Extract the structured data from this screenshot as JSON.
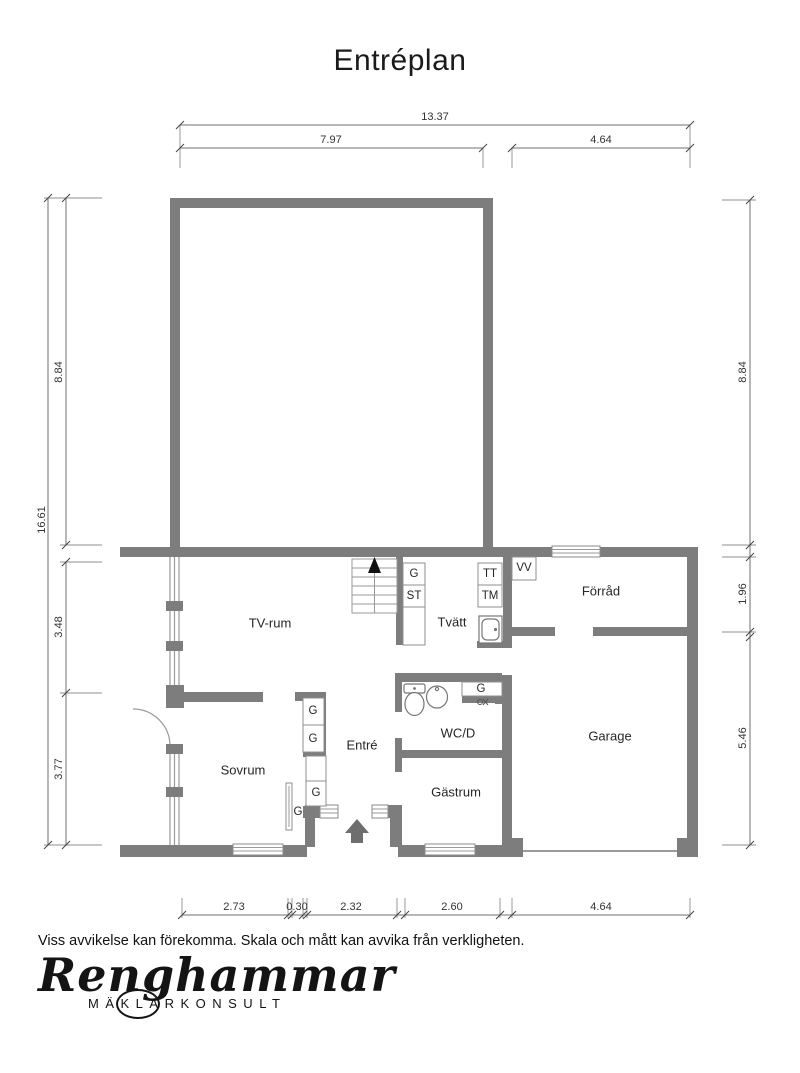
{
  "title": "Entréplan",
  "rooms": {
    "tv_rum": "TV-rum",
    "sovrum": "Sovrum",
    "entre": "Entré",
    "gastrum": "Gästrum",
    "wc": "WC/D",
    "tvatt": "Tvätt",
    "forrad": "Förråd",
    "garage": "Garage"
  },
  "fixtures": {
    "wardrobe": "G",
    "st": "ST",
    "tt": "TT",
    "tm": "TM",
    "vv": "VV"
  },
  "dimensions": {
    "top": {
      "total": "13.37",
      "left": "7.97",
      "right": "4.64"
    },
    "left": {
      "total": "16.61",
      "upper": "8.84",
      "mid": "3.48",
      "lower": "3.77"
    },
    "right": {
      "upper": "8.84",
      "mid": "1.96",
      "lower": "5.46"
    },
    "bottom": {
      "d1": "2.73",
      "d2": "0.30",
      "d3": "2.32",
      "d4": "2.60",
      "d5": "4.64"
    }
  },
  "disclaimer": "Viss avvikelse kan förekomma. Skala och mått kan avvika från verkligheten.",
  "logo": {
    "name": "Renghammar",
    "subtitle": "MÄKLARKONSULT"
  },
  "colors": {
    "wall": "#7d7d7d",
    "dim_line": "#6f6f6f",
    "text": "#1a1a1a"
  }
}
